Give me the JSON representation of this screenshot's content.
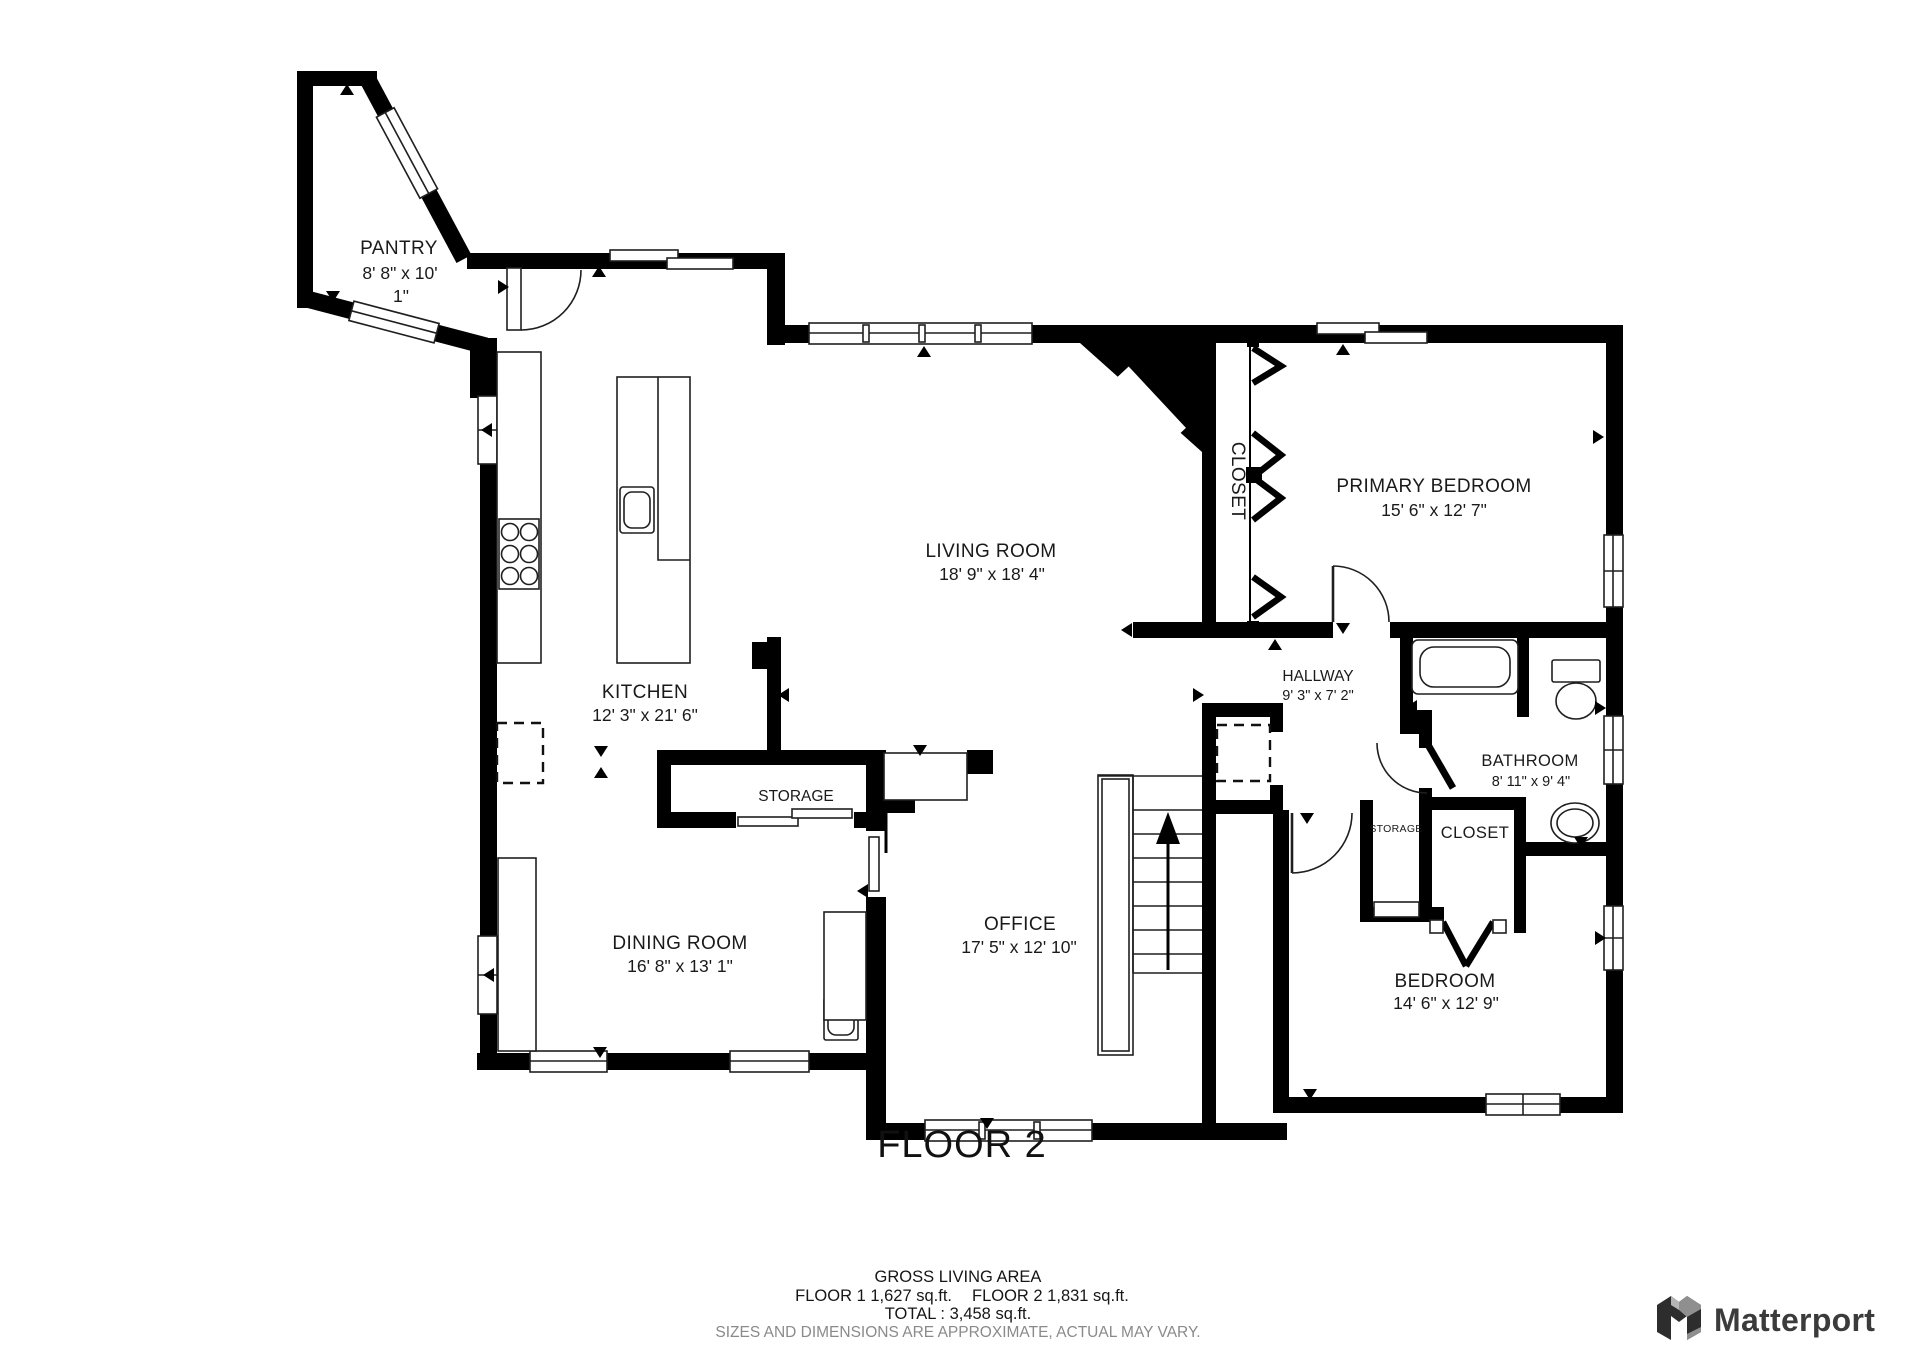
{
  "floor_title": "FLOOR 2",
  "rooms": {
    "pantry": {
      "name": "PANTRY",
      "dims_line1": "8' 8\" x 10'",
      "dims_line2": "1\""
    },
    "kitchen": {
      "name": "KITCHEN",
      "dims": "12' 3\" x 21' 6\""
    },
    "living_room": {
      "name": "LIVING ROOM",
      "dims": "18' 9\" x 18' 4\""
    },
    "dining_room": {
      "name": "DINING ROOM",
      "dims": "16' 8\" x 13' 1\""
    },
    "office": {
      "name": "OFFICE",
      "dims": "17' 5\" x 12' 10\""
    },
    "primary_bedroom": {
      "name": "PRIMARY BEDROOM",
      "dims": "15' 6\" x 12' 7\""
    },
    "bedroom": {
      "name": "BEDROOM",
      "dims": "14' 6\" x 12' 9\""
    },
    "bathroom": {
      "name": "BATHROOM",
      "dims": "8' 11\" x 9' 4\""
    },
    "hallway": {
      "name": "HALLWAY",
      "dims": "9' 3\" x 7' 2\""
    },
    "storage_main": {
      "name": "STORAGE"
    },
    "storage_small": {
      "name": "STORAGE"
    },
    "closet_primary": {
      "name": "CLOSET"
    },
    "closet_bedroom": {
      "name": "CLOSET"
    }
  },
  "footer": {
    "gross_title": "GROSS LIVING AREA",
    "floor1": "FLOOR 1 1,627 sq.ft.",
    "floor2": "FLOOR 2 1,831 sq.ft.",
    "total": "TOTAL :  3,458 sq.ft.",
    "disclaimer": "SIZES AND DIMENSIONS ARE APPROXIMATE, ACTUAL MAY VARY."
  },
  "branding": {
    "logo_text": "Matterport"
  },
  "colors": {
    "wall": "#000000",
    "line": "#1f1f1f",
    "label": "#1a1a1a",
    "muted": "#8a8a8a",
    "logo": "#3b3b3b"
  }
}
